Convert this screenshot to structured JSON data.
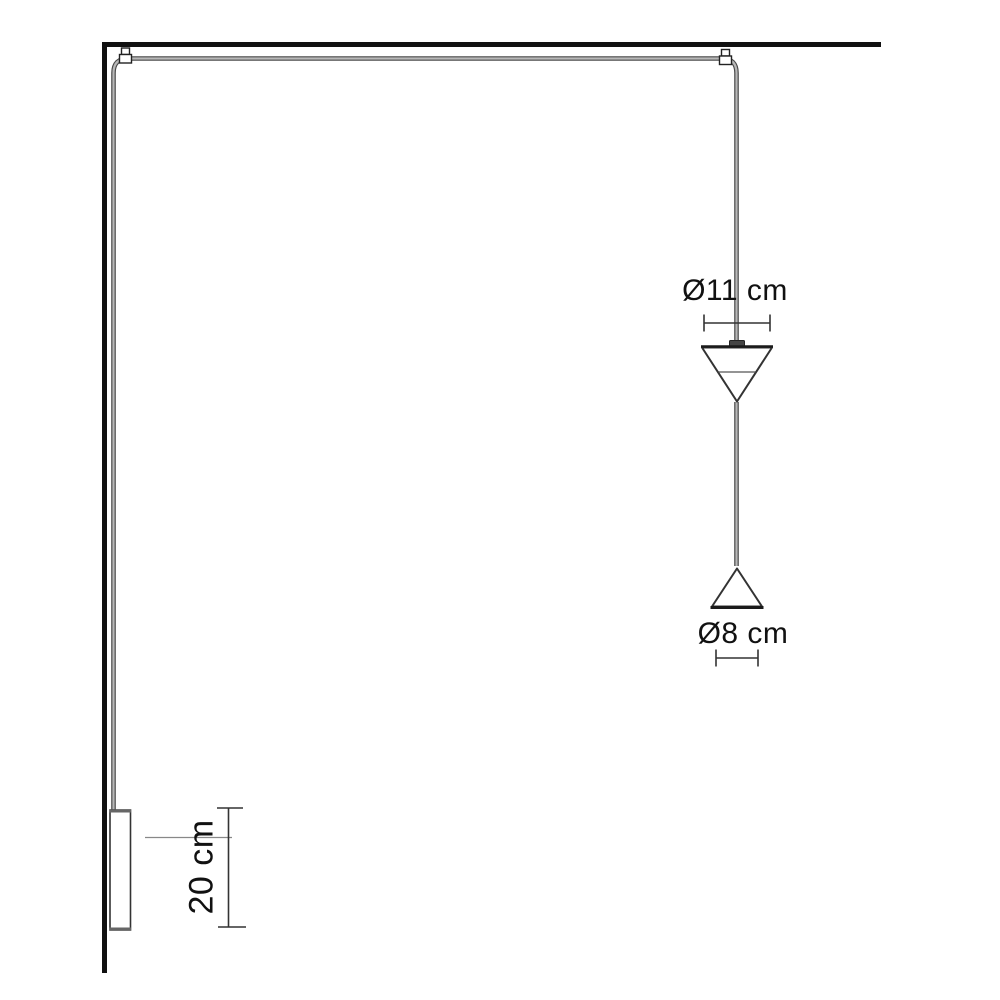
{
  "labels": {
    "upper_shade_diameter": "Ø11 cm",
    "lower_shade_diameter": "Ø8 cm",
    "wall_driver_length": "20 cm"
  },
  "colors": {
    "background": "#ffffff",
    "structure_line": "#111111",
    "outline": "#333333",
    "cable_outline": "#4a4a4a",
    "cable_core": "#b8b8b8",
    "dimension_line": "#333333",
    "label_text": "#111111"
  }
}
